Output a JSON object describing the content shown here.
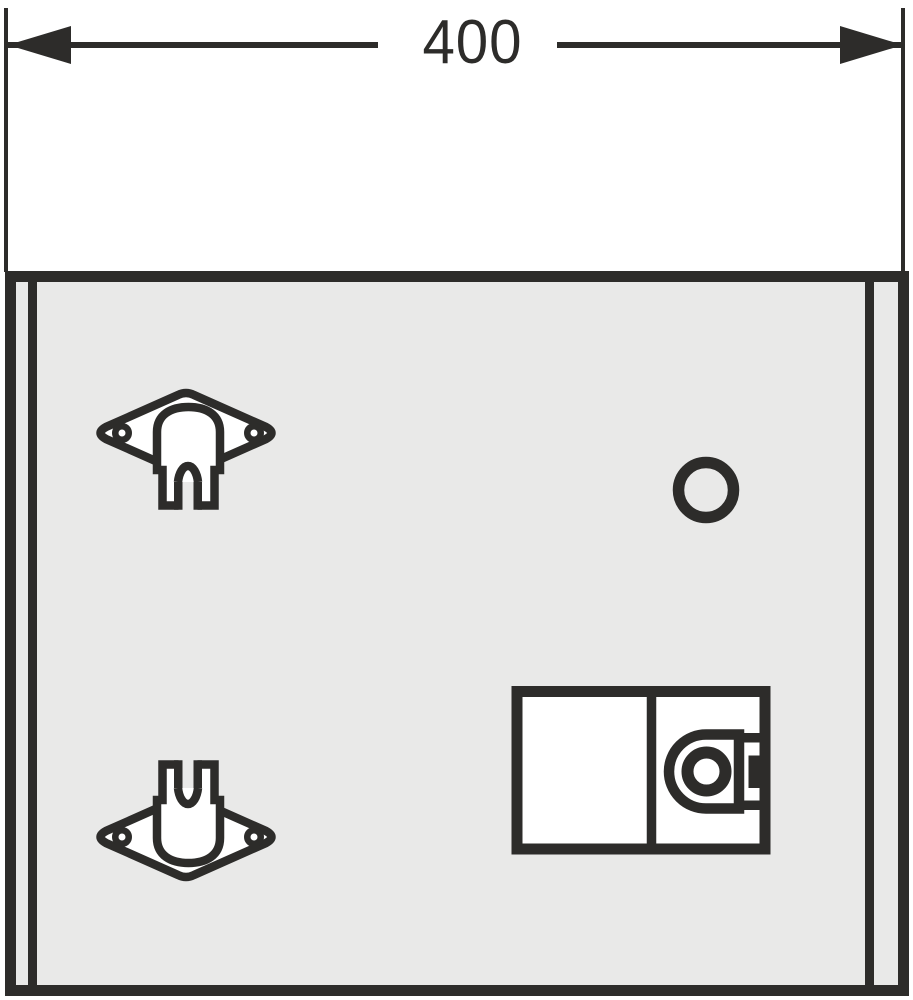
{
  "title": "Cabinet panel assembly drawing",
  "dimension": {
    "label": "400"
  },
  "colors": {
    "line": "#2d2c2a",
    "panel": "#e9e9e8",
    "part_fill": "#ffffff",
    "background": "#ffffff"
  },
  "parts": {
    "bracket_top": "saddle-mounting-bracket-prongs-down",
    "bracket_bottom": "saddle-mounting-bracket-prongs-up",
    "hole": "round-hole",
    "lock": "lock-unit-two-compartments-with-cam-lock"
  }
}
